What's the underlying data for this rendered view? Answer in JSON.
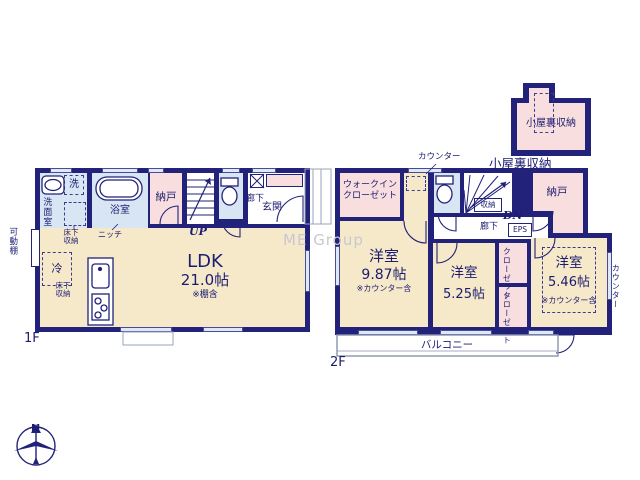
{
  "watermark": "ME Group",
  "compass": {
    "north_label": "N"
  },
  "floor1": {
    "floor_label": "1F",
    "washroom": "洗面室",
    "washer": "洗",
    "bathroom": "浴室",
    "storage": "納戸",
    "stairs_up": "UP",
    "underfloor_storage_a": "床下収納",
    "underfloor_storage_b": "床下収納",
    "niche": "ニッチ",
    "movable_shelf": "可動棚",
    "fridge": "冷",
    "hallway": "廊下",
    "entrance": "玄関",
    "ldk": {
      "name": "LDK",
      "size": "21.0帖",
      "note": "※棚含"
    }
  },
  "floor2": {
    "floor_label": "2F",
    "walk_in_closet_line1": "ウォークイン",
    "walk_in_closet_line2": "クローゼット",
    "counter_top": "カウンター",
    "counter_right": "カウンター",
    "storage": "納戸",
    "stair_storage": "収納",
    "stairs_down": "DN",
    "hallway": "廊下",
    "eps": "EPS",
    "attic_access": "小屋裏収納",
    "closet_a": "クローゼット",
    "closet_b": "クローゼット",
    "bedroom_a": {
      "name": "洋室",
      "size": "9.87帖",
      "note": "※カウンター含"
    },
    "bedroom_b": {
      "name": "洋室",
      "size": "5.25帖"
    },
    "bedroom_c": {
      "name": "洋室",
      "size": "5.46帖",
      "note": "※カウンター含"
    },
    "balcony": "バルコニー"
  },
  "attic": {
    "room_label": "小屋裏収納"
  },
  "colors": {
    "wall": "#22227b",
    "room_cream": "#f6e9c9",
    "room_wet": "#d8e6f4",
    "room_storage": "#f8dede",
    "watermark_gray": "#c8c8cf"
  }
}
